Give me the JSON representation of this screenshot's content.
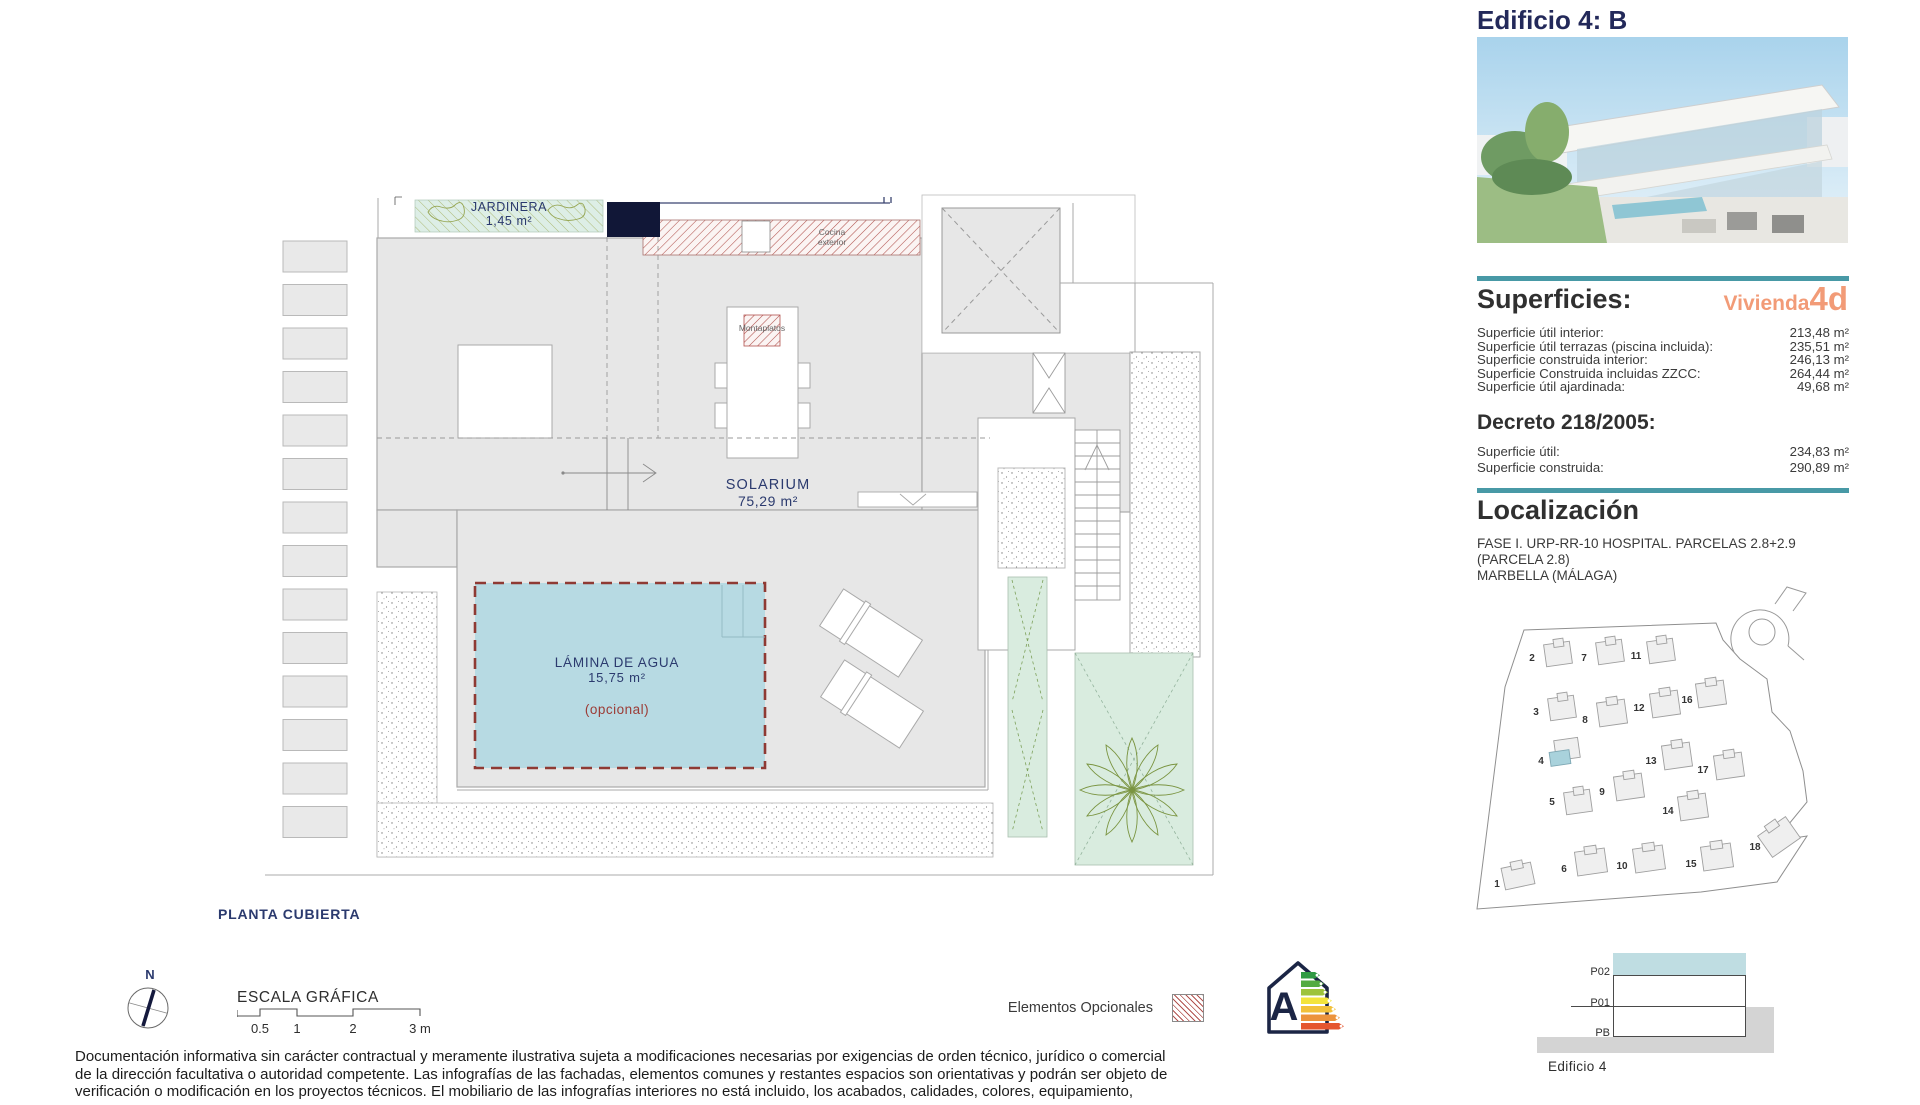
{
  "colors": {
    "accent_teal": "#4899a6",
    "accent_orange": "#f29b77",
    "title_navy": "#23295a",
    "plan_label_navy": "#2b3a6e",
    "optional_red": "#b2524e",
    "pool_fill": "#b7dae3",
    "planter_green": "#d9ecdf",
    "roof_gray": "#e7e7e7"
  },
  "sidebar": {
    "title": "Edificio 4: B",
    "superficies": {
      "heading": "Superficies:",
      "vivienda_label": "Vivienda",
      "vivienda_unit": "4d",
      "rows": [
        {
          "label": "Superficie útil interior:",
          "value": "213,48 m²"
        },
        {
          "label": "Superficie útil terrazas (piscina incluida):",
          "value": "235,51 m²"
        },
        {
          "label": "Superficie construida interior:",
          "value": "246,13 m²"
        },
        {
          "label": "Superficie Construida incluidas ZZCC:",
          "value": "264,44 m²"
        },
        {
          "label": "Superficie útil ajardinada:",
          "value": "49,68 m²"
        }
      ]
    },
    "decreto": {
      "heading": "Decreto 218/2005:",
      "rows": [
        {
          "label": "Superficie útil:",
          "value": "234,83 m²"
        },
        {
          "label": "Superficie construida:",
          "value": "290,89 m²"
        }
      ]
    },
    "localizacion": {
      "heading": "Localización",
      "address_lines": [
        "FASE I. URP-RR-10 HOSPITAL. PARCELAS 2.8+2.9",
        "(PARCELA 2.8)",
        "MARBELLA (MÁLAGA)"
      ],
      "map_numbers": [
        "1",
        "2",
        "3",
        "4",
        "5",
        "6",
        "7",
        "8",
        "9",
        "10",
        "11",
        "12",
        "13",
        "14",
        "15",
        "16",
        "17",
        "18"
      ]
    },
    "section": {
      "levels": [
        "P02",
        "P01",
        "PB"
      ],
      "caption": "Edificio 4"
    }
  },
  "plan": {
    "title": "PLANTA CUBIERTA",
    "labels": {
      "jardinera_name": "JARDINERA",
      "jardinera_area": "1,45 m²",
      "solarium_name": "SOLARIUM",
      "solarium_area": "75,29 m²",
      "pool_name": "LÁMINA DE AGUA",
      "pool_area": "15,75 m²",
      "pool_optional": "(opcional)",
      "montaplatos": "Montaplatos",
      "cocina_exterior": "Cocina exterior"
    },
    "north_label": "N",
    "scale": {
      "title": "ESCALA GRÁFICA",
      "ticks": [
        "0.5",
        "1",
        "2",
        "3 m"
      ]
    },
    "legend": {
      "optional_label": "Elementos Opcionales"
    },
    "energy_rating": "A"
  },
  "disclaimer": {
    "lines": [
      "Documentación informativa sin carácter contractual y meramente ilustrativa sujeta a modificaciones necesarias por exigencias de orden técnico, jurídico o comercial",
      "de la dirección facultativa o autoridad competente. Las infografías de las fachadas, elementos comunes y restantes espacios son orientativas y podrán ser objeto de",
      "verificación o modificación en los proyectos técnicos. El mobiliario de las infografías interiores no está incluido, los acabados, calidades, colores, equipamiento,"
    ]
  }
}
